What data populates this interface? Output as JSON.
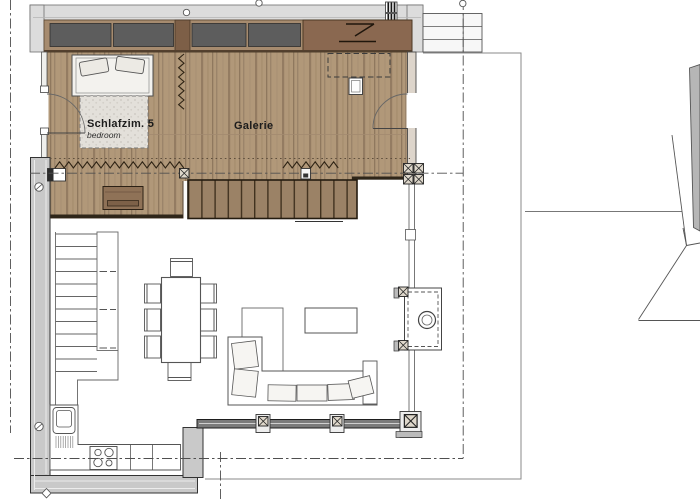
{
  "meta": {
    "type": "architectural floor plan (gallery / upper level)",
    "language": "German"
  },
  "rooms": [
    {
      "name": "Schlafzim. 5",
      "subtitle": "bedroom"
    },
    {
      "name": "Galerie"
    }
  ],
  "colors": {
    "background": "#ffffff",
    "wood_floor": "#b19879",
    "wood_streak": "#947c62",
    "stair_tread_bg": "#9b8266",
    "stair_tread_line": "#41321f",
    "window_glazing": "#5d5d5d",
    "window_frame": "#a68b6f",
    "window_mullion": "#7d5f47",
    "wardrobe_panel": "#8a6850",
    "sideboard": "#8f7257",
    "wall_concrete": "#c9c9c9",
    "roof_band": "#dcdcdc",
    "veranda_wall": "#7b7b7b",
    "drawing_line": "#4f4f4f",
    "blanket": "#e3e0da"
  },
  "symbols": {
    "axis_lines": "dash-dot reference axes",
    "zigzag": "curtain / railing symbol",
    "x_post": "timber post marker",
    "door_arc": "door swing",
    "dashed_rect": "element above (skylight outline)",
    "stove_circle": "wood stove flue"
  }
}
